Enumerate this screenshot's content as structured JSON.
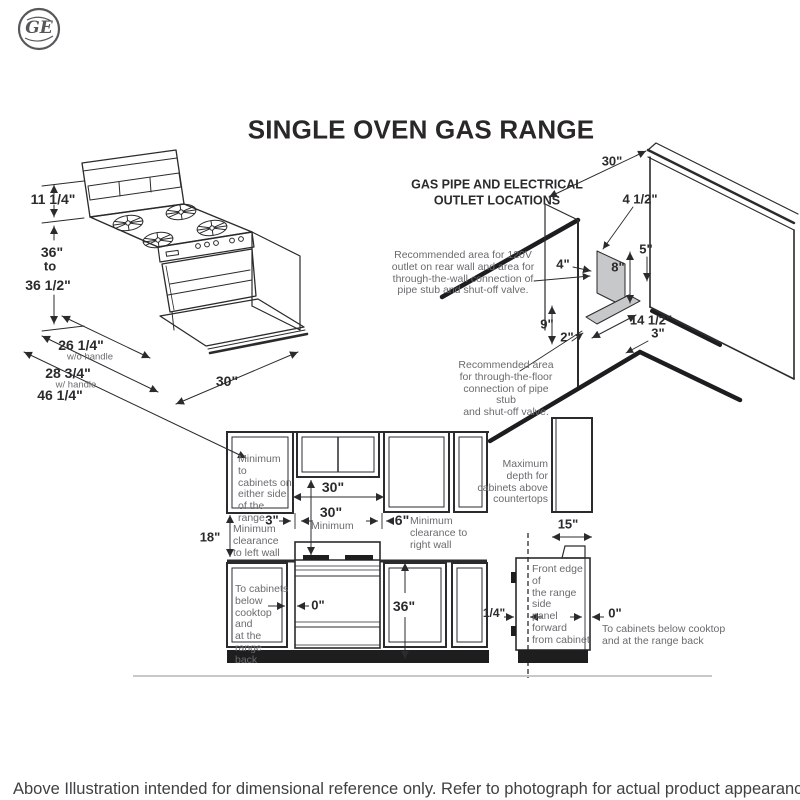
{
  "logo": {
    "monogram": "GE"
  },
  "title": "SINGLE OVEN GAS RANGE",
  "iso": {
    "d_backguard_height": "11 1/4\"",
    "d_height_top": "36\"",
    "d_height_mid": "to",
    "d_height_bottom": "36 1/2\"",
    "d_depth_no_handle": "26 1/4\"",
    "d_depth_no_handle_sub": "w/o handle",
    "d_depth_handle": "28 3/4\"",
    "d_depth_handle_sub": "w/ handle",
    "d_depth_door_open": "46 1/4\"",
    "d_width": "30\""
  },
  "gas": {
    "heading": "GAS PIPE AND ELECTRICAL\nOUTLET LOCATIONS",
    "d_wall_width": "30\"",
    "d_outlet_offset": "4 1/2\"",
    "d_outlet_top": "5\"",
    "d_corner_offset": "4\"",
    "d_outlet_height": "8\"",
    "d_floor_height": "9\"",
    "d_floor_corner": "2\"",
    "d_floor_width": "14 1/2\"",
    "d_floor_depth": "3\"",
    "note_wall": "Recommended area for 120V\noutlet on rear wall and area for\nthrough-the-wall connection of\npipe stub and shut-off valve.",
    "note_floor": "Recommended area\nfor through-the-floor\nconnection of pipe stub\nand shut-off valve."
  },
  "front": {
    "note_side_cabinets": "Minimum to\ncabinets on\neither side\nof the range.",
    "d_opening": "30\"",
    "d_side_clearance": "3\"",
    "d_vertical_min": "30\"",
    "d_vertical_min_sub": "Minimum",
    "d_right_clearance": "6\"",
    "note_right_wall": "Minimum\nclearance to\nright wall",
    "d_cabinet_to_counter": "18\"",
    "note_left_wall": "Minimum\nclearance\nto left wall",
    "note_below_cabinets": "To cabinets\nbelow\ncooktop and\nat the range\nback",
    "d_zero": "0\"",
    "d_counter_height": "36\""
  },
  "side": {
    "note_max_depth": "Maximum\ndepth for\ncabinets above\ncountertops",
    "d_cabinet_depth": "15\"",
    "note_front_edge": "Front edge of\nthe range side\npanel forward\nfrom cabinet",
    "d_quarter": "1/4\"",
    "d_zero": "0\"",
    "note_below_cabinets": "To cabinets below cooktop\nand at the range back"
  },
  "footer": "Above Illustration intended for dimensional reference only. Refer to photograph for actual product appearance."
}
